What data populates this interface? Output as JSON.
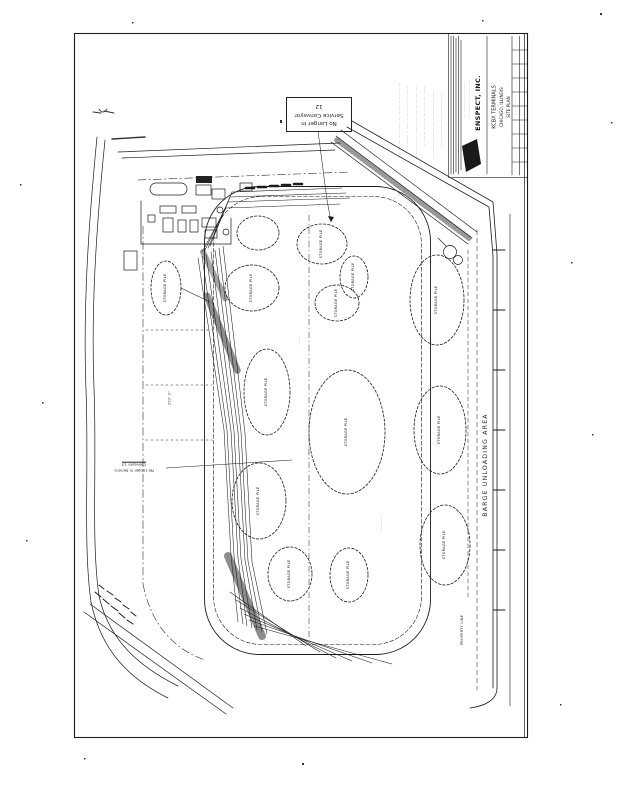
{
  "sheet": {
    "kind": "scanned engineering site plan",
    "ink_color": "#1c1c1c",
    "paper_color": "#ffffff"
  },
  "title_block": {
    "company": "ENSPECT,  INC.",
    "address_line1": "···· ········ ······ ···· ·····",
    "address_line2": "······ ······· ··· ····· ··· ······",
    "project": "KCBX TERMINALS",
    "location": "CHICAGO, ILLINOIS",
    "sheet_title": "SITE PLAN",
    "grid_dots": "·· · ··· · ·· · ··"
  },
  "notes": {
    "lines": [
      "·········· ···· ····· ········ ··· ········· ····· ······ ····",
      "···· ········ ·· ······· ········ ····· ··· ·········",
      "········ ····· ···· ········· ······ ···· ······· ····· ·····",
      "··· ········· ······ ·· ····· ······· ···· ·······",
      "········· ···· ······ ··· ········ ····· ········ ······",
      "····· ······· ···· ···· ········ ··· ······"
    ]
  },
  "callout": {
    "line1": "No Longer in",
    "line2": "Service Conveyor",
    "line3": "12"
  },
  "service_note": {
    "line1": "No Longer in Service",
    "line2": "Conveyor 13"
  },
  "labels": {
    "barge_area": "BARGE UNLOADING AREA",
    "storage_pile": "STORAGE PILE",
    "property_line": "PROPERTY LINE",
    "dim_250": "250'-0\"",
    "conveyor_dots_1": "······ ····",
    "conveyor_dots_2": "···· ·······",
    "conveyor_dots_3": "·······",
    "diag_band": "··· ········ ····"
  }
}
